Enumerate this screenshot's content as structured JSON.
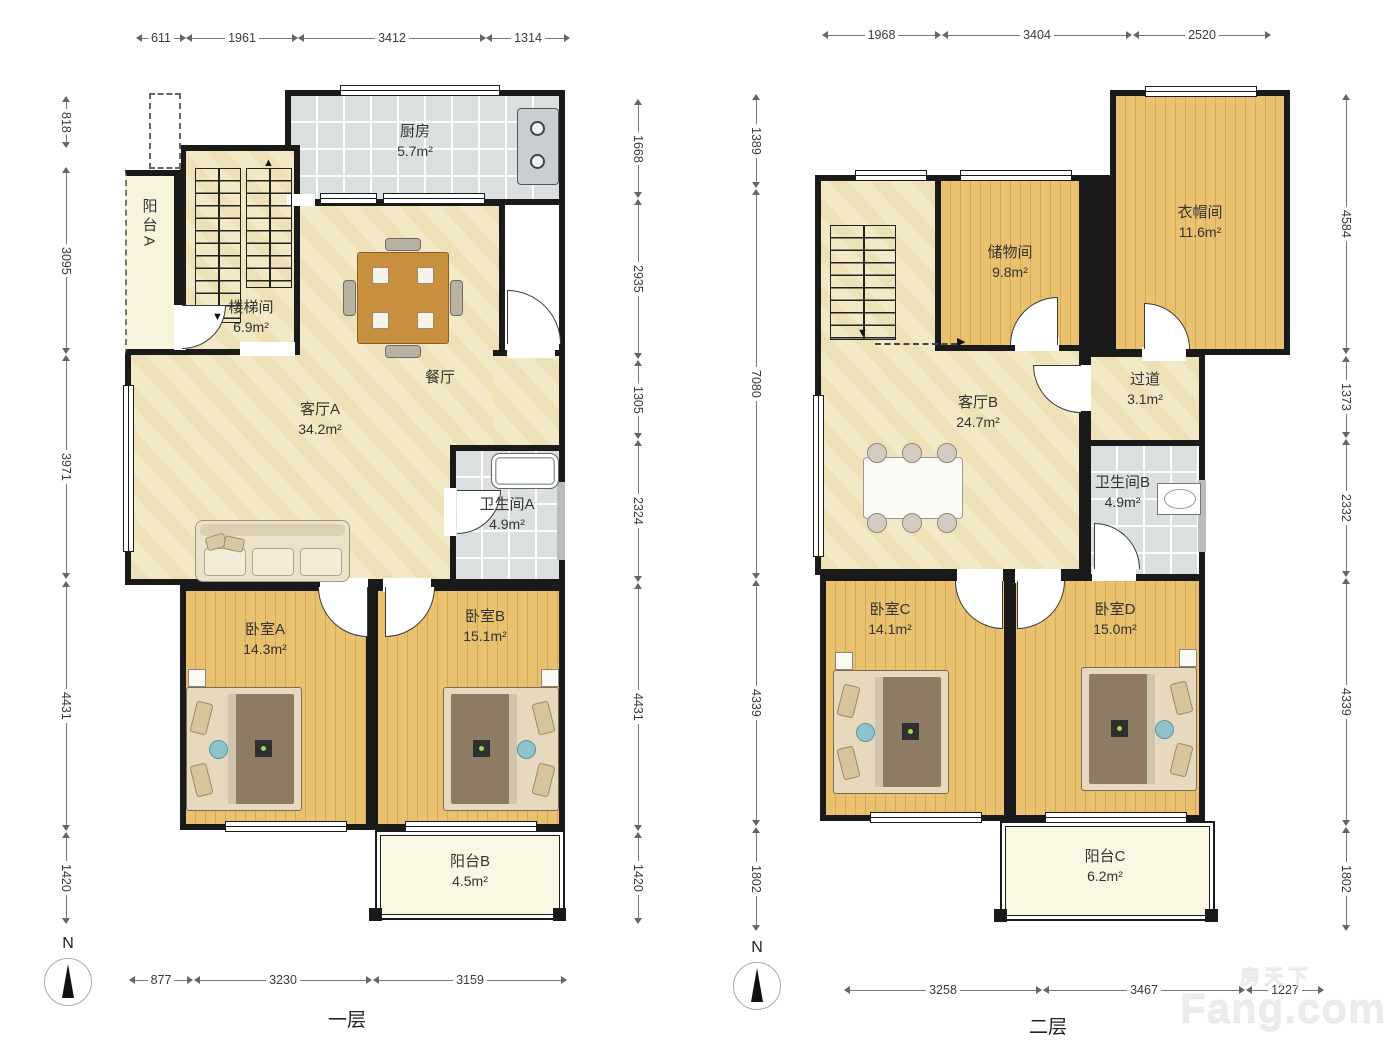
{
  "page": {
    "floor1_label": "一层",
    "floor2_label": "二层",
    "north_label": "N"
  },
  "watermark": {
    "cn": "房天下",
    "en": "Fang.com"
  },
  "plan1": {
    "rooms": {
      "kitchen": {
        "name": "厨房",
        "area": "5.7m²"
      },
      "balcony_a": {
        "name": "阳台A"
      },
      "stairwell": {
        "name": "楼梯间",
        "area": "6.9m²"
      },
      "living_a": {
        "name": "客厅A",
        "area": "34.2m²"
      },
      "dining": {
        "name": "餐厅"
      },
      "bath_a": {
        "name": "卫生间A",
        "area": "4.9m²"
      },
      "bedroom_a": {
        "name": "卧室A",
        "area": "14.3m²"
      },
      "bedroom_b": {
        "name": "卧室B",
        "area": "15.1m²"
      },
      "balcony_b": {
        "name": "阳台B",
        "area": "4.5m²"
      }
    },
    "dims": {
      "top": [
        "611",
        "1961",
        "3412",
        "1314"
      ],
      "left": [
        "818",
        "3095",
        "3971",
        "4431",
        "1420"
      ],
      "right": [
        "1668",
        "2935",
        "1305",
        "2324",
        "4431",
        "1420"
      ],
      "bottom": [
        "877",
        "3230",
        "3159"
      ]
    }
  },
  "plan2": {
    "rooms": {
      "storage": {
        "name": "储物间",
        "area": "9.8m²"
      },
      "cloakroom": {
        "name": "衣帽间",
        "area": "11.6m²"
      },
      "hallway": {
        "name": "过道",
        "area": "3.1m²"
      },
      "living_b": {
        "name": "客厅B",
        "area": "24.7m²"
      },
      "bath_b": {
        "name": "卫生间B",
        "area": "4.9m²"
      },
      "bedroom_c": {
        "name": "卧室C",
        "area": "14.1m²"
      },
      "bedroom_d": {
        "name": "卧室D",
        "area": "15.0m²"
      },
      "balcony_c": {
        "name": "阳台C",
        "area": "6.2m²"
      }
    },
    "dims": {
      "top": [
        "1968",
        "3404",
        "2520"
      ],
      "left": [
        "1389",
        "7080",
        "4339",
        "1802"
      ],
      "right": [
        "4584",
        "1373",
        "2332",
        "4339",
        "1802"
      ],
      "bottom": [
        "3258",
        "3467",
        "1227"
      ]
    }
  }
}
